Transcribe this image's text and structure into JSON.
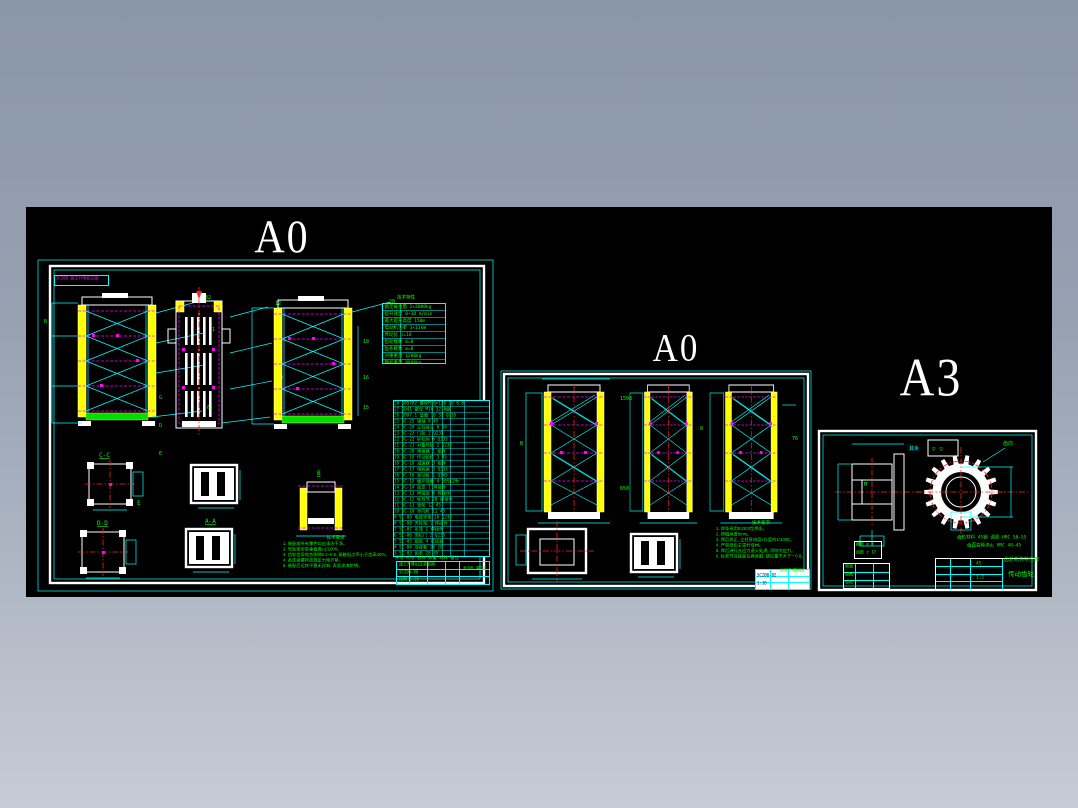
{
  "colors": {
    "bg_top": "#8a96aa",
    "bg_bottom": "#c6ccd6",
    "canvas": "#000000",
    "line_cyan": "#00ffff",
    "line_green": "#00ff00",
    "line_yellow": "#ffff00",
    "line_magenta": "#ff00ff",
    "line_red": "#ff2020",
    "line_white": "#ffffff"
  },
  "sheets": {
    "s1": {
      "label": "A0",
      "corner_tag": "SC200 施工升降机总图",
      "side_letters": [
        "B",
        "G",
        "D",
        "E"
      ],
      "balloons_t1": [
        "32",
        "31",
        "7",
        "6",
        "5",
        "4",
        "3"
      ],
      "balloons_t2": [
        "12",
        "11",
        "10",
        "9",
        "8"
      ],
      "balloons_t3": [
        "20",
        "18",
        "16",
        "15"
      ],
      "sections": {
        "cc": "C-C",
        "dd": "D-D",
        "aa": "A-A",
        "b": "B",
        "e": "E"
      },
      "param_table": {
        "title": "技术特性",
        "rows": [
          "额定载重量 2×2000kg",
          "提升速度 0~38 m/min",
          "最大提升高度 150m",
          "电动机功率 3×11kW",
          "传动比 i=16",
          "齿轮模数 m=8",
          "齿条模数 m=8",
          "对重重量 1200kg",
          "整机重量 9800kg"
        ]
      },
      "bom_rows": [
        "28 GB5782 螺栓M16×120 16 8.8",
        "27 GB41 螺母 M16 32 8级",
        "26 GB97.1 垫圈 16 32 Q235",
        "25 SC-25 销轴 8 45",
        "24 SC-24 立柱接头 8 20",
        "23 SC-23 门轨 2 Q235",
        "22 SC-22 护栏网 6 Q235",
        "21 SC-21 对重导轨 2 Q235",
        "20 SC-20 限速器 1 组件",
        "19 SC-19 传动齿轮 3 45",
        "18 SC-18 减速器 3 组件",
        "17 SC-17 电机座 3 Q235",
        "16 SC-16 驱动板 1 Q345",
        "15 SC-15 缓冲弹簧 4 60Si2Mn",
        "14 SC-14 底笼 1 焊接件",
        "13 SC-13 附墙架 6 焊接件",
        "12 SC-12 标准节 28 焊接件",
        "11 SC-11 背轮 12 45",
        "10 SC-10 导向轮 12 45",
        "9 SC-09 电缆导架 10 Q235",
        "8 SC-08 天轮架 1 焊接件",
        "7 SC-07 吊笼 1 焊接件",
        "6 SC-06 围栏门 2 Q235",
        "5 SC-05 踏板 4 花纹板",
        "4 SC-04 连接套 16 20",
        "3 SC-03 齿条 28 45",
        "2 SC-02 直腹杆 112 20#管",
        "1 SC-01 立柱管 12 20#管"
      ],
      "bom_footer": "序号 代号 名称 数量 材料 备注",
      "notes": {
        "heading": "技术要求",
        "lines": [
          "1. 装配前所有零件均应清洗干净。",
          "2. 导轨架安装垂直度≤1/1000。",
          "3. 齿轮齿条啮合侧隙0.2~0.5, 接触斑点不小于齿高40%。",
          "4. 各连接螺栓按规定力矩拧紧。",
          "5. 装配后运转平稳无异响, 表面涂漆防锈。"
        ]
      },
      "title_block": {
        "name": "施工升降机总装配图",
        "no": "SC200-00",
        "scale": "比例 1:25",
        "sheet_info": "共3张 第1张"
      }
    },
    "s2": {
      "label": "A0",
      "notes": {
        "heading": "技术要求",
        "lines": [
          "1. 焊条采用E4303型焊条。",
          "2. 焊缝高度6mm。",
          "3. 焊后矫正, 立柱直线度≤长度的1/1000。",
          "4. 严禁烧伤主弦杆母材。",
          "5. 焊后进行去应力退火处理, 消除内应力。",
          "6. 标准节对接面互换装配, 错位量不大于一0.8。"
        ]
      },
      "dim_labels": [
        "1508",
        "650",
        "76",
        "8"
      ],
      "title_block": {
        "name": "标准节焊接图",
        "no": "SC200-02",
        "scale": "1:10"
      }
    },
    "s3": {
      "label": "A3",
      "roughness_prefix": "其余",
      "roughness_symbols": "▽ ▽",
      "gear_callout": "齿向",
      "notes": [
        "齿轮材料 45钢·调质 HRC 50—55",
        "齿面高频淬火 HRC 40—45"
      ],
      "left_table_rows": [
        "制图",
        "描图",
        "审核"
      ],
      "spec_box_rows": [
        "模数 m 8",
        "齿数 z 17"
      ],
      "title_block": {
        "name": "传动齿轮",
        "material": "45",
        "scale": "1:2",
        "label": "齿轮机构特性表"
      }
    }
  }
}
